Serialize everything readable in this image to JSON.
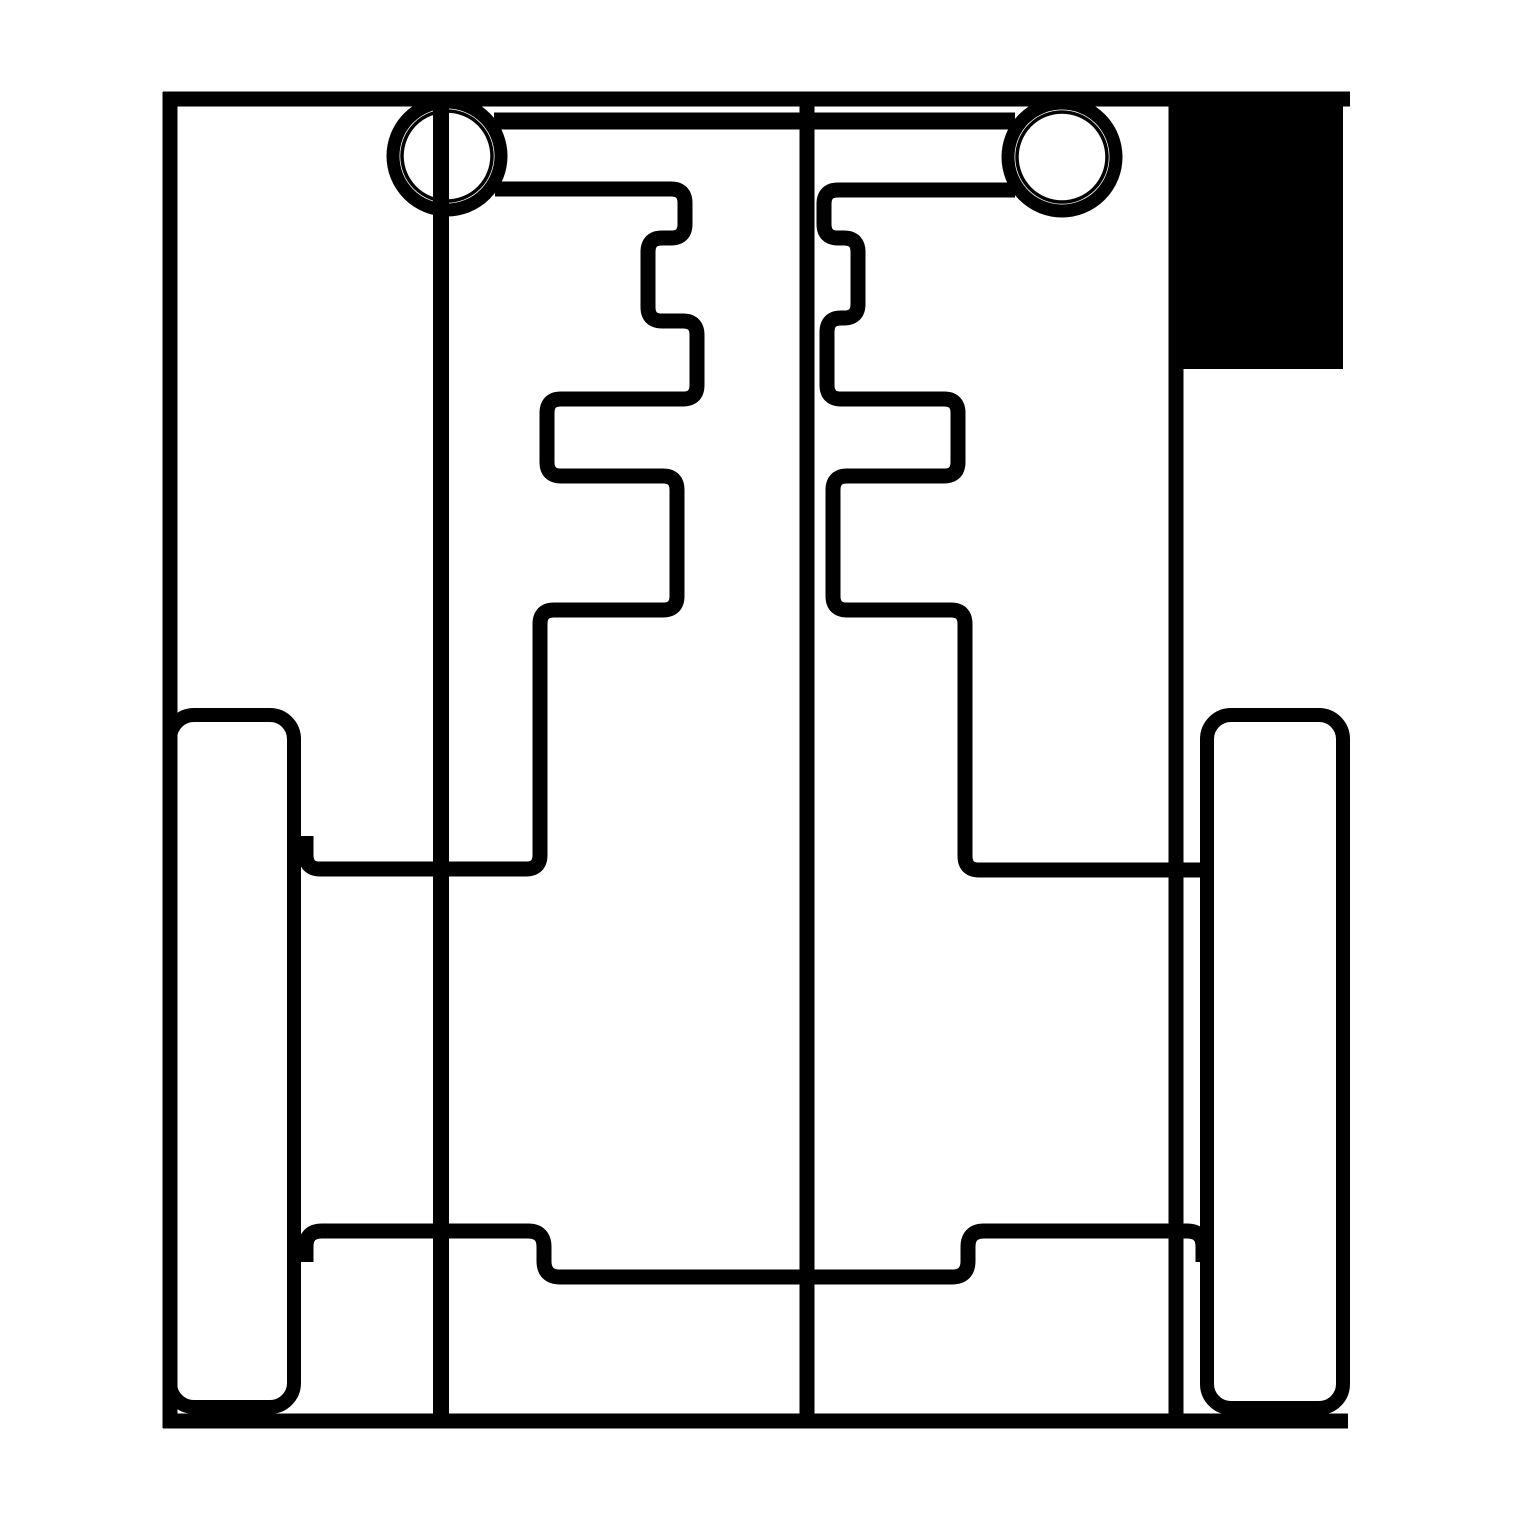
{
  "drawing": {
    "title": "cad-flat-pattern-line-drawing",
    "width": 1519,
    "height": 1519,
    "background_color": "#ffffff",
    "ink_color": "#000000",
    "shapes": [
      {
        "name": "outer-frame-top-edge",
        "type": "line",
        "pts": [
          163,
          99,
          1350,
          99
        ],
        "w": 15
      },
      {
        "name": "outer-frame-left-edge",
        "type": "line",
        "pts": [
          170,
          92,
          170,
          1428
        ],
        "w": 15
      },
      {
        "name": "outer-frame-right-edge",
        "type": "line",
        "pts": [
          1176,
          92,
          1176,
          1428
        ],
        "w": 15
      },
      {
        "name": "outer-frame-bottom-edge",
        "type": "line",
        "pts": [
          163,
          1421,
          1348,
          1421
        ],
        "w": 15
      },
      {
        "name": "filled-corner-block",
        "type": "frect",
        "x": 1169,
        "y": 92,
        "w": 174,
        "h": 277
      },
      {
        "name": "left-pivot-ring-outer",
        "type": "circle",
        "cx": 447,
        "cy": 156,
        "r": 54,
        "w": 13
      },
      {
        "name": "left-pivot-ring-inner",
        "type": "circle",
        "cx": 447,
        "cy": 156,
        "r": 45,
        "w": 3.5
      },
      {
        "name": "right-pivot-ring-outer",
        "type": "circle",
        "cx": 1062,
        "cy": 157,
        "r": 54,
        "w": 13
      },
      {
        "name": "right-pivot-ring-inner",
        "type": "circle",
        "cx": 1062,
        "cy": 157,
        "r": 45,
        "w": 3.5
      },
      {
        "name": "pivot-crossbar",
        "type": "line",
        "pts": [
          494,
          121,
          1015,
          121
        ],
        "w": 17
      },
      {
        "name": "left-axle-line",
        "type": "line",
        "pts": [
          441,
          96,
          441,
          1418
        ],
        "w": 16
      },
      {
        "name": "center-axle-line",
        "type": "line",
        "pts": [
          807,
          96,
          807,
          1418
        ],
        "w": 15
      },
      {
        "name": "left-comb-profile",
        "type": "poly",
        "r": 14,
        "w": 15,
        "pts": [
          [
            495,
            189
          ],
          [
            685,
            189
          ],
          [
            685,
            238
          ],
          [
            648,
            238
          ],
          [
            648,
            321
          ],
          [
            697,
            321
          ],
          [
            697,
            399
          ],
          [
            547,
            399
          ],
          [
            547,
            476
          ],
          [
            677,
            476
          ],
          [
            677,
            610
          ],
          [
            540,
            610
          ],
          [
            540,
            869
          ],
          [
            306,
            869
          ],
          [
            306,
            836
          ]
        ]
      },
      {
        "name": "right-comb-profile",
        "type": "poly",
        "r": 14,
        "w": 15,
        "pts": [
          [
            1015,
            190
          ],
          [
            824,
            190
          ],
          [
            824,
            238
          ],
          [
            858,
            238
          ],
          [
            858,
            318
          ],
          [
            827,
            318
          ],
          [
            827,
            399
          ],
          [
            958,
            399
          ],
          [
            958,
            476
          ],
          [
            833,
            476
          ],
          [
            833,
            610
          ],
          [
            965,
            610
          ],
          [
            965,
            870
          ],
          [
            1213,
            870
          ]
        ]
      },
      {
        "name": "lower-crossmember",
        "type": "poly",
        "r": 16,
        "w": 15,
        "pts": [
          [
            306,
            1262
          ],
          [
            306,
            1231
          ],
          [
            544,
            1231
          ],
          [
            544,
            1277
          ],
          [
            968,
            1277
          ],
          [
            968,
            1231
          ],
          [
            1203,
            1231
          ],
          [
            1203,
            1262
          ]
        ]
      },
      {
        "name": "left-runner-outline",
        "type": "rrect",
        "x": 170,
        "y": 715,
        "w": 124,
        "h": 692,
        "r": 24,
        "sw": 14
      },
      {
        "name": "right-runner-outline",
        "type": "rrect",
        "x": 1207,
        "y": 715,
        "w": 136,
        "h": 693,
        "r": 24,
        "sw": 14
      }
    ]
  }
}
